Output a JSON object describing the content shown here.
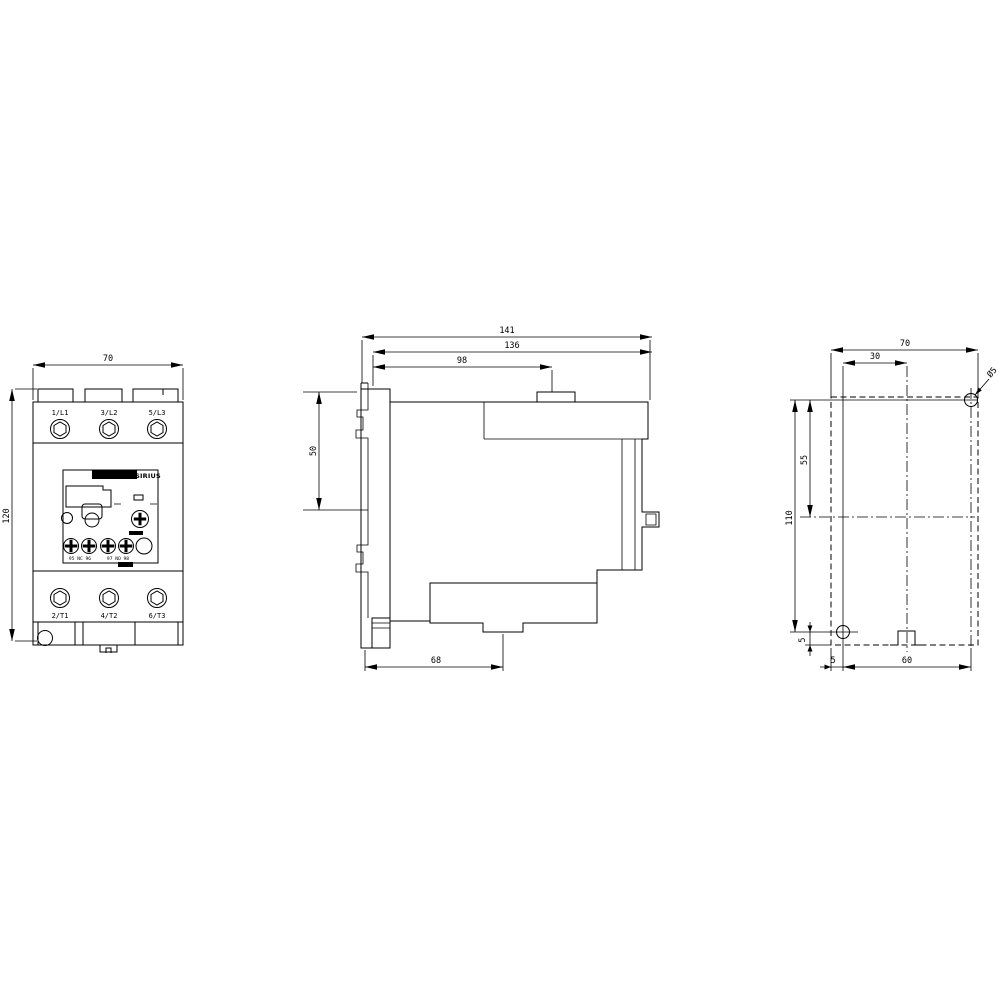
{
  "drawing": {
    "front_view": {
      "dim_width": "70",
      "dim_height": "120",
      "terminals_top": [
        "1/L1",
        "3/L2",
        "5/L3"
      ],
      "terminals_bottom": [
        "2/T1",
        "4/T2",
        "6/T3"
      ],
      "panel": {
        "brand": "SIRIUS",
        "aux_left": "95 NC 96",
        "aux_right": "97 NO 98"
      }
    },
    "side_view": {
      "dim_depth_total": "141",
      "dim_depth_body": "136",
      "dim_depth_top": "98",
      "dim_din_clip": "50",
      "dim_depth_base": "68"
    },
    "rear_view": {
      "dim_width": "70",
      "dim_hole_offset_x": "30",
      "hole_diameter": "Ø5",
      "dim_hole_spacing_v": "110",
      "dim_center_v": "55",
      "dim_hole_edge_bottom": "5",
      "dim_hole_edge_left": "5",
      "dim_hole_spacing_h": "60"
    },
    "colors": {
      "line": "#000000",
      "background": "#ffffff"
    }
  }
}
